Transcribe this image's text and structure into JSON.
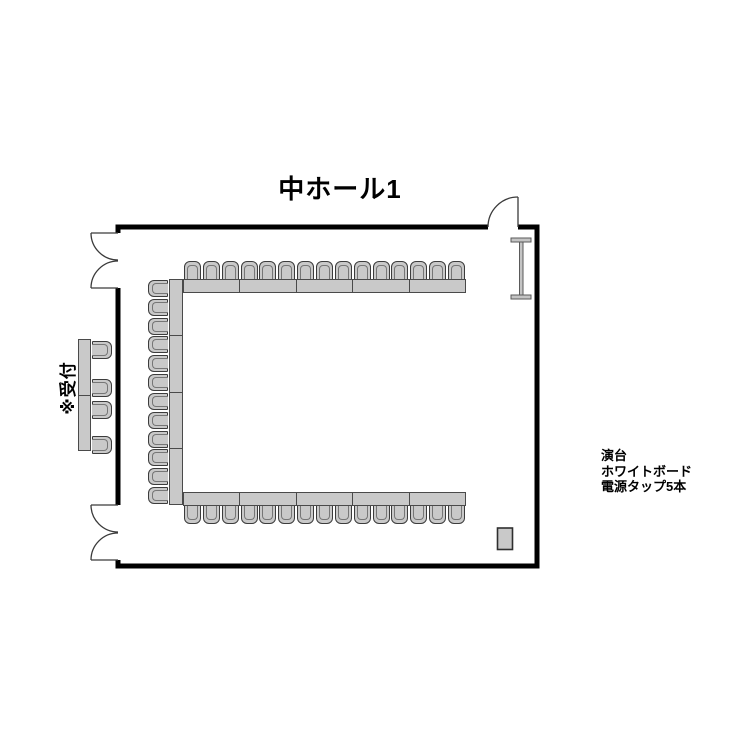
{
  "title": "中ホール1",
  "reception_label": "※受付",
  "equipment_notes": [
    "演台",
    "ホワイトボード",
    "電源タップ5本"
  ],
  "furniture": {
    "top_row_chairs": 15,
    "bottom_row_chairs": 15,
    "left_column_chairs": 12,
    "reception_chairs": 4,
    "top_table_segments": 5,
    "bottom_table_segments": 5,
    "left_table_segments": 4,
    "reception_table_segments": 2
  },
  "symbols": {
    "whiteboard": "whiteboard-symbol",
    "podium": "podium-marker",
    "doors": [
      "door-top-left",
      "door-bottom-left",
      "door-top-right"
    ]
  },
  "colors": {
    "wall": "#000000",
    "furniture_fill": "#c9c9c9",
    "furniture_border": "#4a4a4a"
  }
}
